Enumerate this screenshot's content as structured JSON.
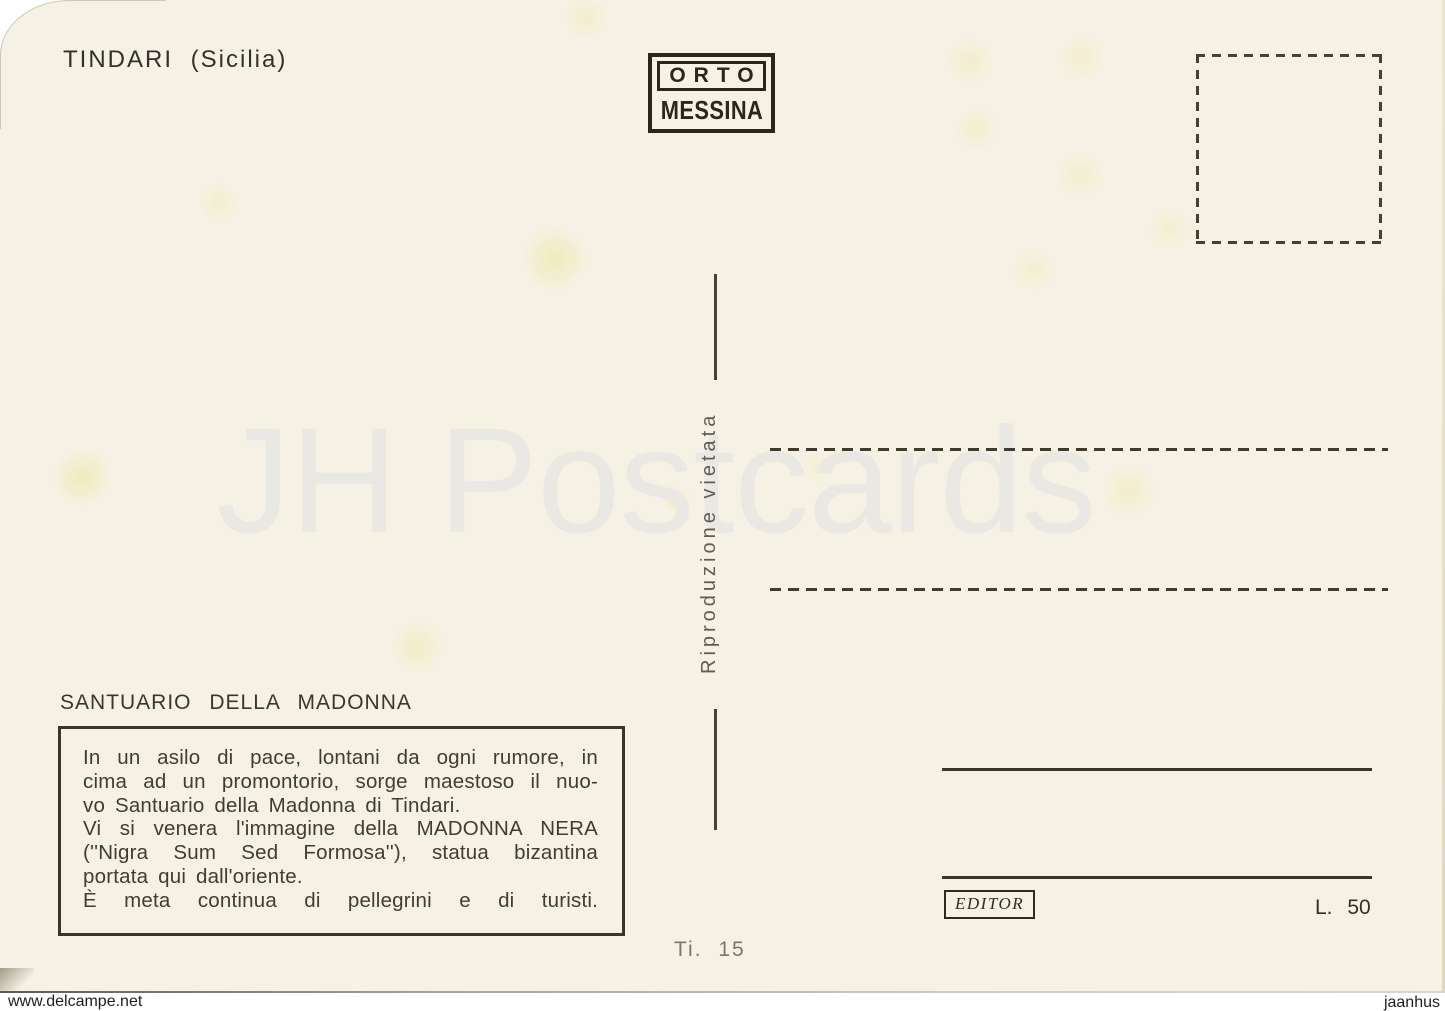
{
  "postcard": {
    "location_title": "TINDARI (Sicilia)",
    "publisher": {
      "name_top": "ORTO",
      "name_bottom": "MESSINA"
    },
    "reproduction_note": "Riproduzione vietata",
    "section_heading": "SANTUARIO DELLA MADONNA",
    "description_lines": [
      "In un asilo di pace, lontani da ogni rumore, in",
      "cima ad un promontorio, sorge maestoso il nuo-",
      "vo Santuario della Madonna di Tindari.",
      "Vi si venera l'immagine della MADONNA NERA",
      "(''Nigra Sum Sed Formosa''), statua bizantina",
      "portata qui dall'oriente.",
      "È meta continua di pellegrini e di turisti."
    ],
    "series_number": "Ti. 15",
    "editor_label": "EDITOR",
    "price_label": "L. 50"
  },
  "watermarks": {
    "center_logo": "JH Postcards",
    "bottom_left": "www.delcampe.net",
    "bottom_right": "jaanhus"
  },
  "colors": {
    "card_background": "#f5f2e5",
    "ink": "#39352a",
    "note_gray": "#615c51",
    "watermark_gray": "#e9e8e2"
  }
}
